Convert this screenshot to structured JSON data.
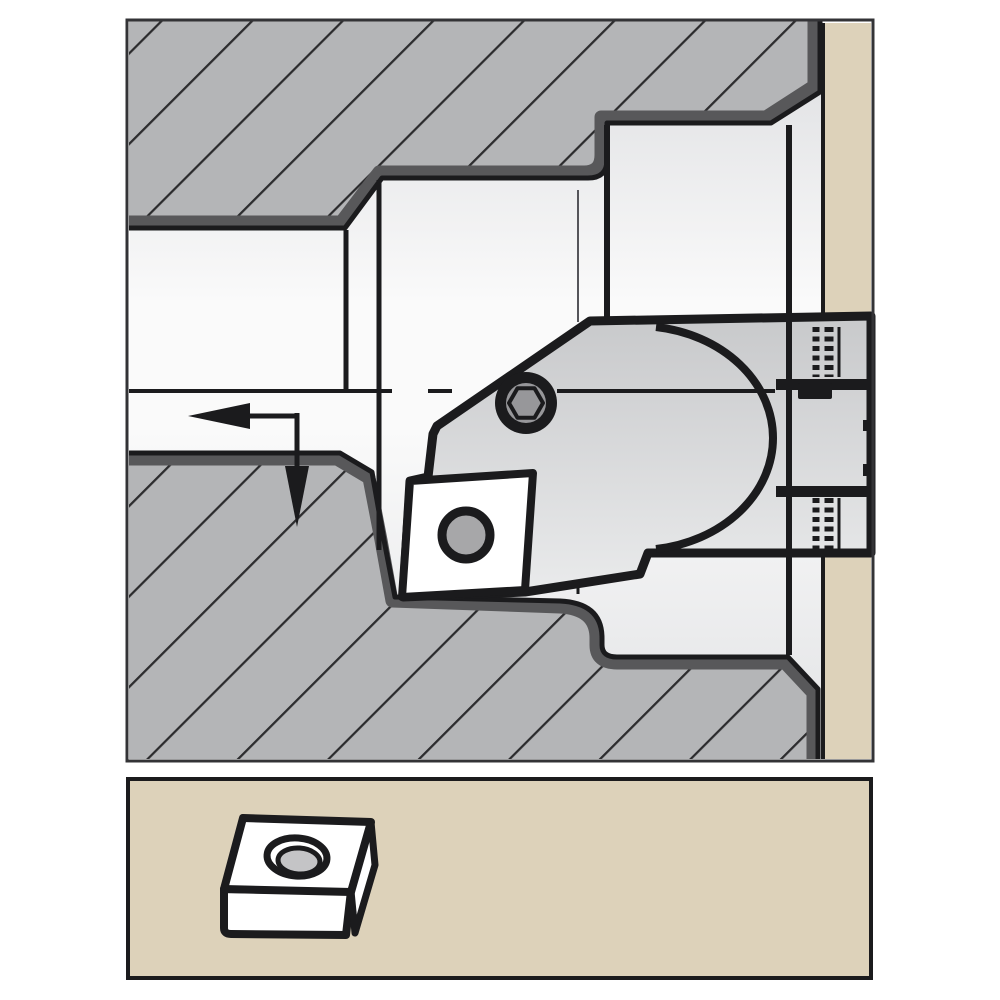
{
  "meta": {
    "description": "Technical line illustration: cross-section of an indexable-insert boring head machining a stepped bore in a workpiece, with a separate detail view of the indexable insert below",
    "visible_text": [],
    "panels": [
      "main-section-view",
      "insert-detail-view"
    ]
  },
  "colors": {
    "page_bg": "#ffffff",
    "ink": "#1b1b1d",
    "panel_border": "#333336",
    "hatch_fill": "#b4b5b7",
    "hatch_line": "#2c2c2e",
    "band": "#58585a",
    "bore_top": "#dcdde0",
    "bore_mid": "#fafafa",
    "bore_bottom": "#e2e3e5",
    "metal_light": "#c8c9cb",
    "metal_lighter": "#eaebec",
    "tan": "#ddd2ba",
    "screw_center": "#97979a",
    "insert_hole": "#a7a7a9",
    "detail_hole": "#c4c4c6",
    "white": "#ffffff"
  },
  "components": {
    "upper_workpiece": "workpiece cross-section, upper half (hatched)",
    "lower_workpiece": "workpiece cross-section, lower half (hatched)",
    "backing_plate": "fixture backing plate (tan strip)",
    "tool_head": "boring head body with insert cartridge",
    "clamp_screw": "hex-socket clamp screw",
    "insert_section": "indexable insert engaged in the corner (section view)",
    "feed_arrow": "feed direction arrow (left, then down)",
    "centerline": "bore centerline",
    "insert_detail": "indexable insert, 3D detail view with center hole"
  }
}
